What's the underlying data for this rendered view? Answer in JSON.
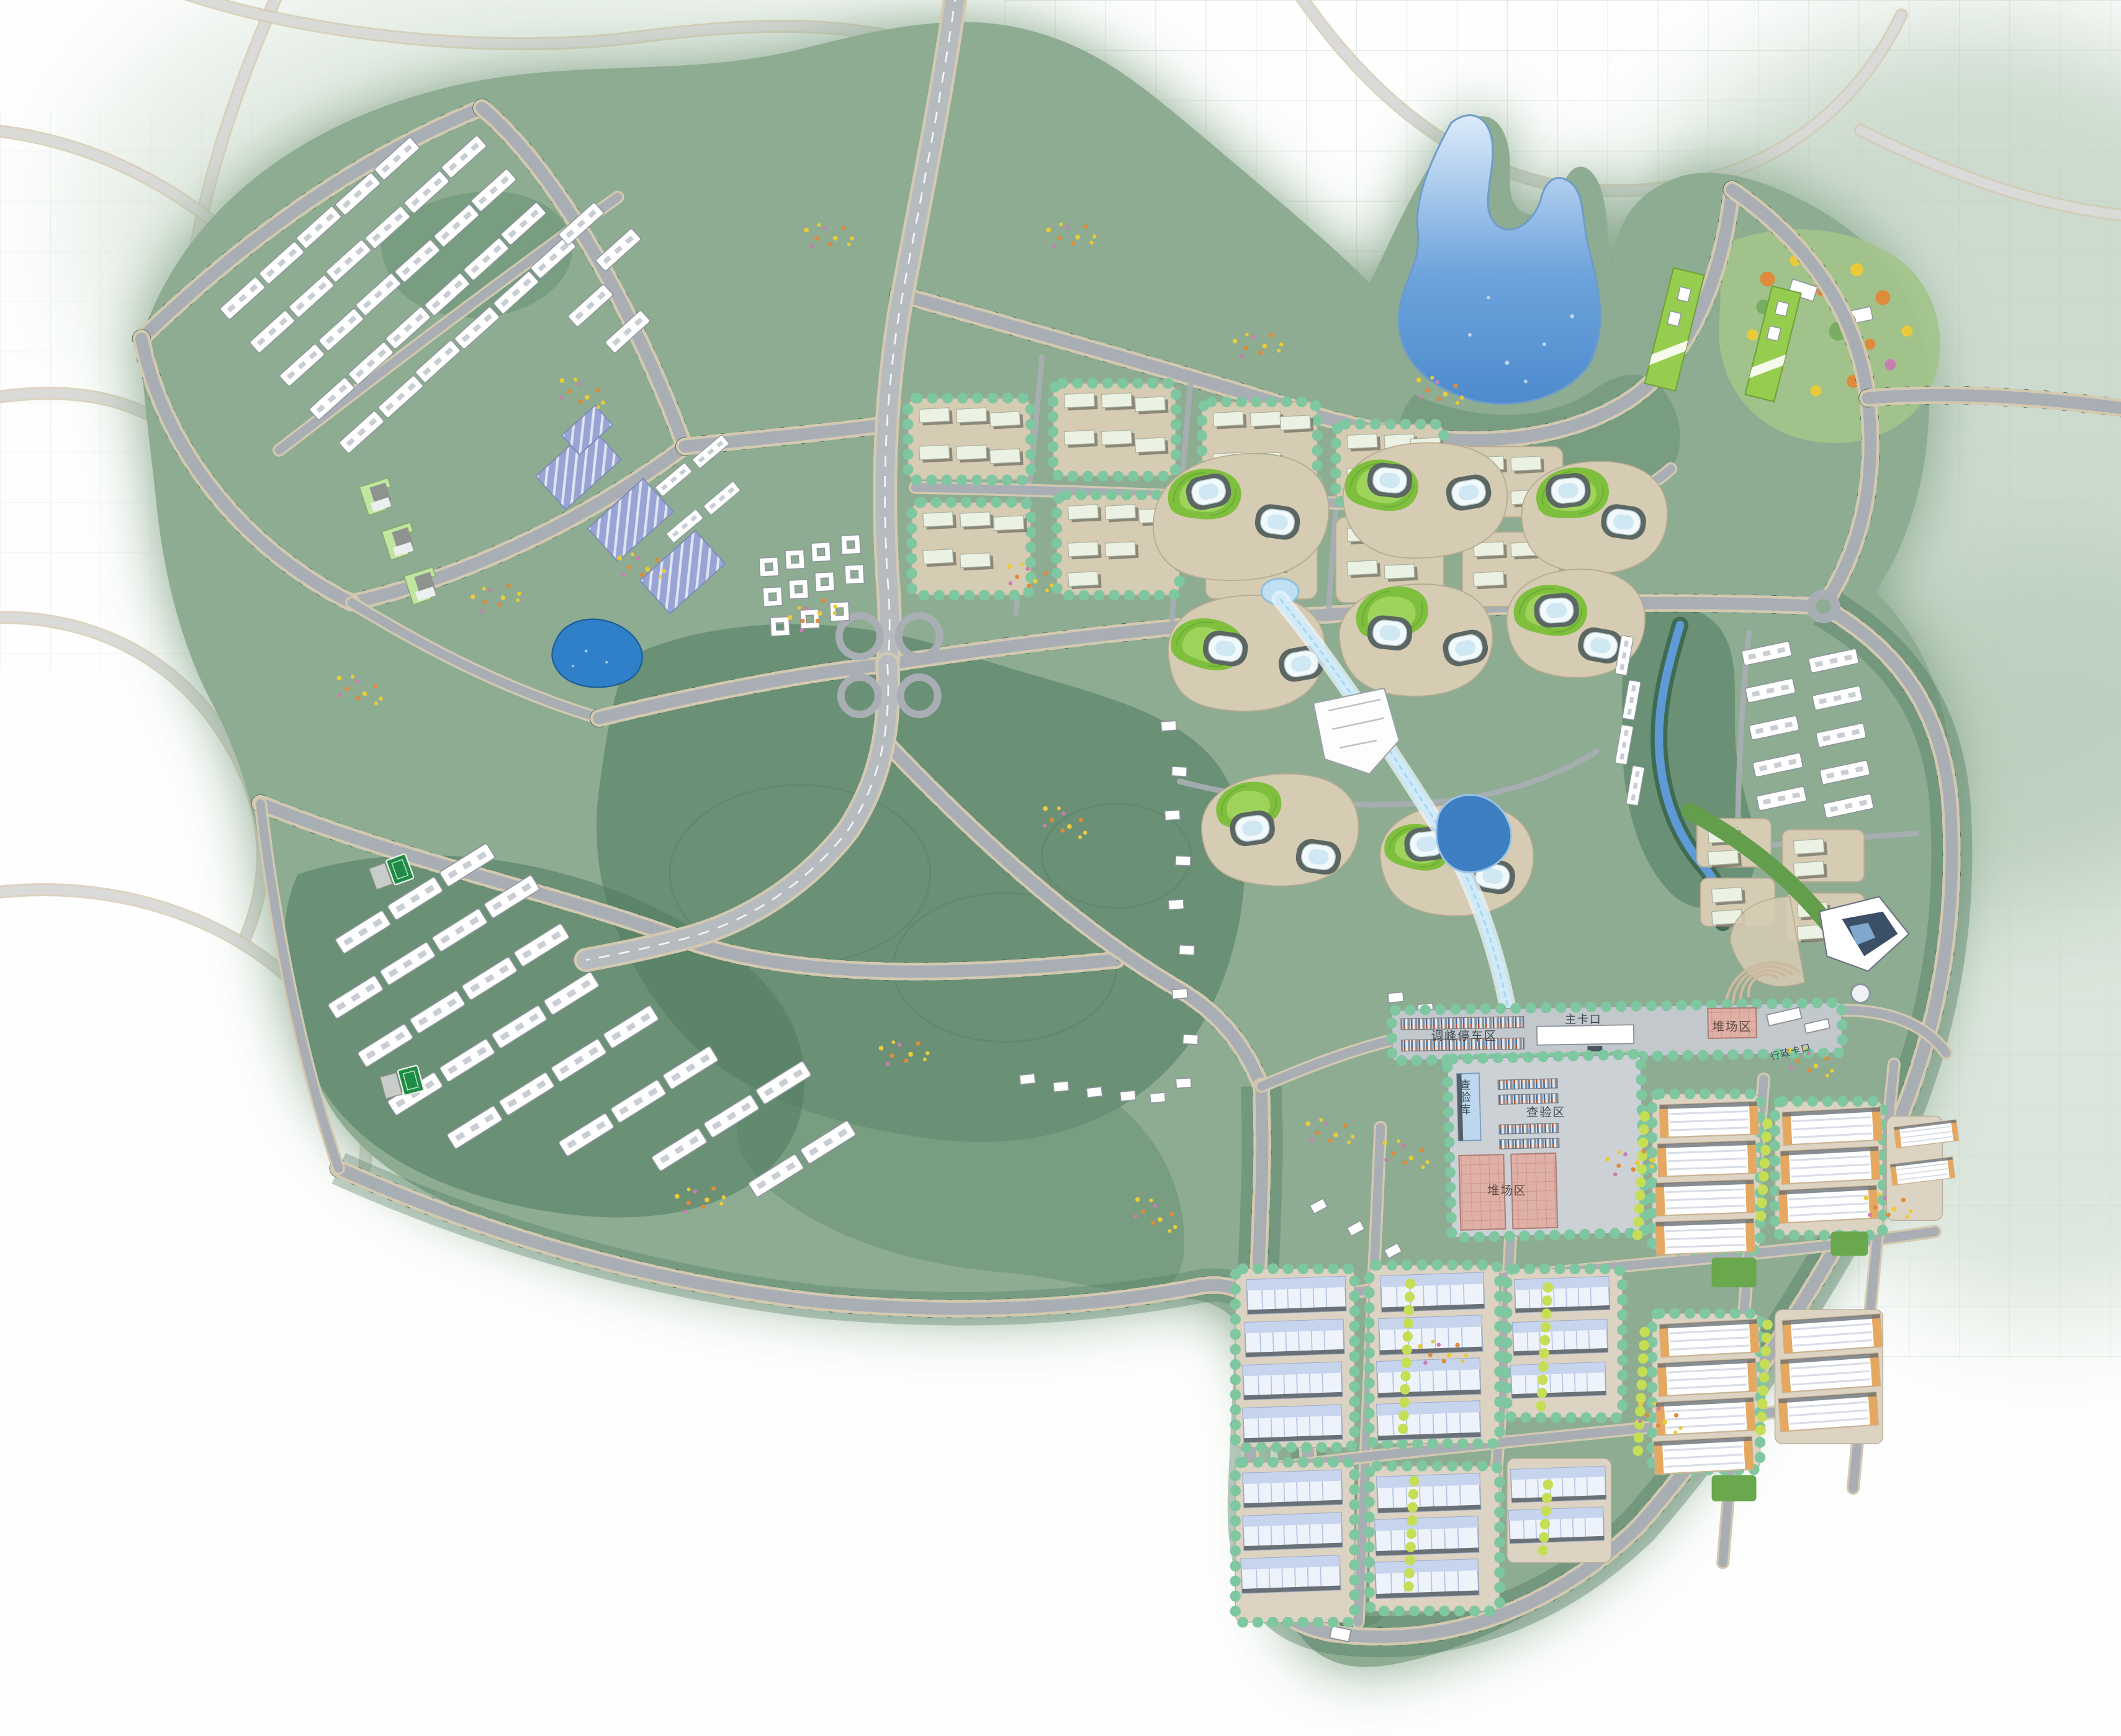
{
  "meta": {
    "kind": "urban-master-plan-rendering",
    "orientation": "top-down"
  },
  "labels": {
    "peak_parking": "调峰停车区",
    "main_gate": "主卡口",
    "yard_building": "堆场区",
    "admin_gate": "行政卡口",
    "inspection_warehouse": "查验库",
    "inspection_area": "查验区",
    "yard_area": "堆场区"
  },
  "palette": {
    "bg": "#fdfefd",
    "halo": "#85a489",
    "site": "#8dac92",
    "forest": "#4e7a5e",
    "forest2": "#6b9274",
    "lawn": "#a3c48b",
    "ghost": "#dadad8",
    "casing": "#d3c9b0",
    "road": "#a9aeb4",
    "hwy": "#b6bbc0",
    "treeD": "#2e5a40",
    "treeL": "#7fc7a0",
    "limetree": "#c6de55",
    "waterhi": "#dcebfa",
    "watermid": "#6ea3dc",
    "waterlo": "#4d8bcd",
    "pond": "#2f80c8",
    "canal": "#cfeaf8",
    "bld": "#ffffff",
    "mint": "#ecf2e3",
    "mintshadow": "#3f463d",
    "beige": "#d6cbb3",
    "beige2": "#ddd3c3",
    "twring": "#5c6662",
    "mound1": "#7fbf3e",
    "mound2": "#9fd45c",
    "greenroof": "#96cd4e",
    "worange": "#e5a861",
    "dock": "#697076",
    "court": "#1f8c45",
    "fyellow": "#e9cb3a",
    "forange": "#de8b3c",
    "fpink": "#c97fb0",
    "platform": "#c3c8cd",
    "platform2": "#ccd1d6",
    "labeldark": "#3c4a52",
    "labelred": "#5c4a44",
    "grid": "#c3cdc4"
  }
}
